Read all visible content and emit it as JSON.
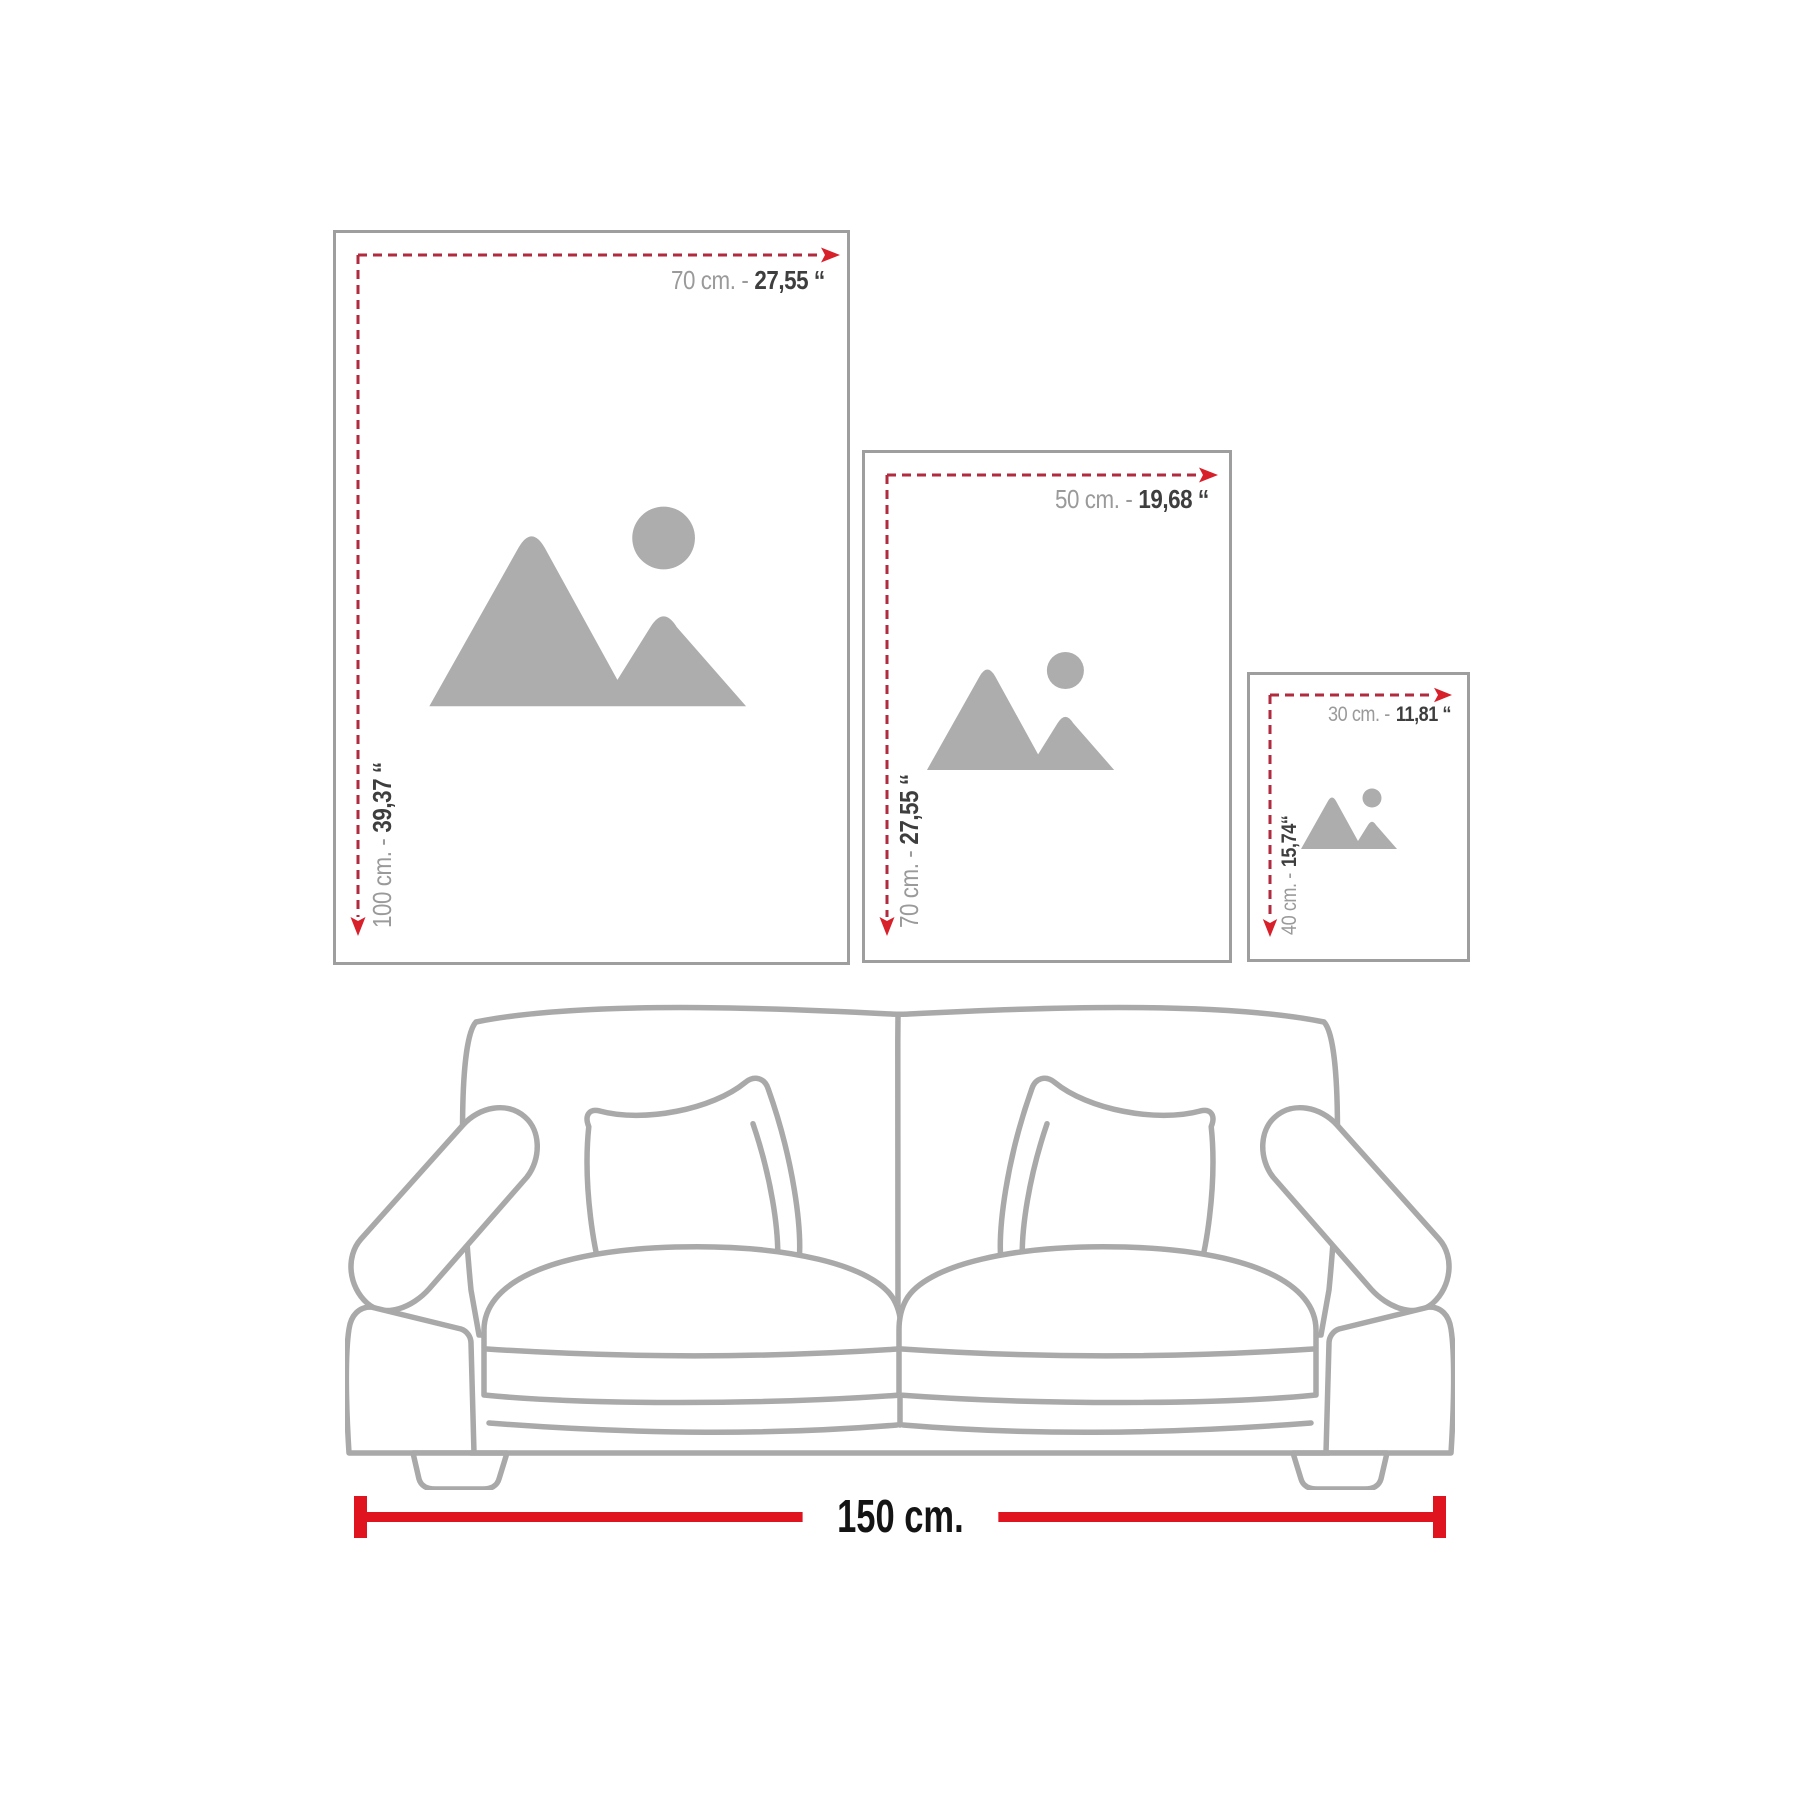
{
  "title": "Wall art size guide diagram",
  "colors": {
    "frame_border": "#9e9e9e",
    "dash_color": "#b12a3d",
    "arrow_color": "#d7202a",
    "gray_text": "#9a9a9a",
    "dark_text": "#3e3e3e",
    "placeholder": "#adadad",
    "sofa_line": "#a9a9a9",
    "bar_red": "#e0141f",
    "measure_text": "#141414",
    "bg": "#ffffff"
  },
  "frames": [
    {
      "id": "large",
      "width_gray": "70 cm. -",
      "width_dark": "27,55 ‘‘",
      "height_gray": "100 cm. -",
      "height_dark": "39,37 ‘‘"
    },
    {
      "id": "medium",
      "width_gray": "50 cm. -",
      "width_dark": "19,68 ‘‘",
      "height_gray": "70 cm. -",
      "height_dark": "27,55 ‘‘"
    },
    {
      "id": "small",
      "width_gray": "30 cm. -",
      "width_dark": "11,81 ‘‘",
      "height_gray": "40 cm. -",
      "height_dark": "15,74‘‘"
    }
  ],
  "sofa": {
    "width_label": "150 cm."
  },
  "icons": {
    "placeholder": "image-placeholder mountains and sun"
  }
}
